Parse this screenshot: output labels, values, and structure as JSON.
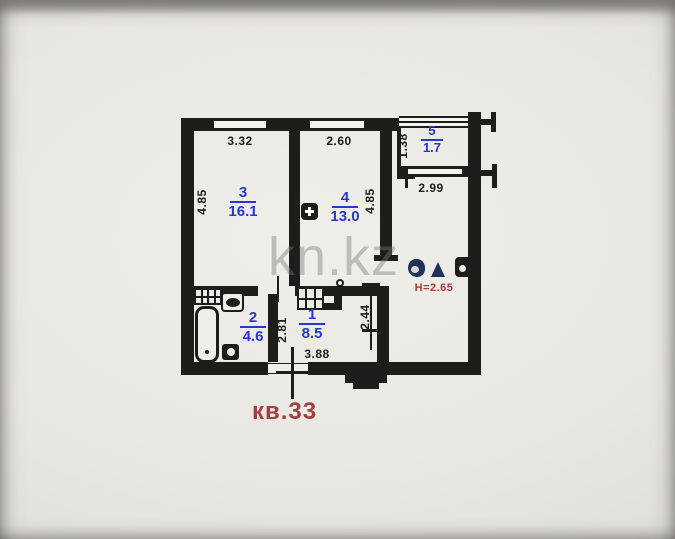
{
  "watermark": "kn.kz",
  "apartment": {
    "label": "кв.33",
    "ceiling_height": "Н=2.65"
  },
  "rooms": {
    "r1": {
      "number": "1",
      "area": "8.5"
    },
    "r2": {
      "number": "2",
      "area": "4.6"
    },
    "r3": {
      "number": "3",
      "area": "16.1"
    },
    "r4": {
      "number": "4",
      "area": "13.0"
    },
    "r5": {
      "number": "5",
      "area": "1.7"
    }
  },
  "dimensions": {
    "room3_width": "3.32",
    "room4_width": "2.60",
    "left_height": "4.85",
    "room4_height": "4.85",
    "balcony_depth": "1.38",
    "balcony_width": "2.99",
    "bath_height": "2.81",
    "hall_height": "2.44",
    "hall_width": "3.88"
  },
  "icons": {
    "electrical_panel": "plus-in-square",
    "vent_shaft": "square-with-hole",
    "stamp": "blob-and-triangle",
    "bath_vent_grille": "hatched-grid",
    "closet": "hatched-grid-with-step"
  },
  "colors": {
    "wall": "#1e1d1b",
    "ink": "#1c1c1c",
    "blue": "#2838c8",
    "red": "#a04040",
    "paper": "#e9e7e2"
  }
}
